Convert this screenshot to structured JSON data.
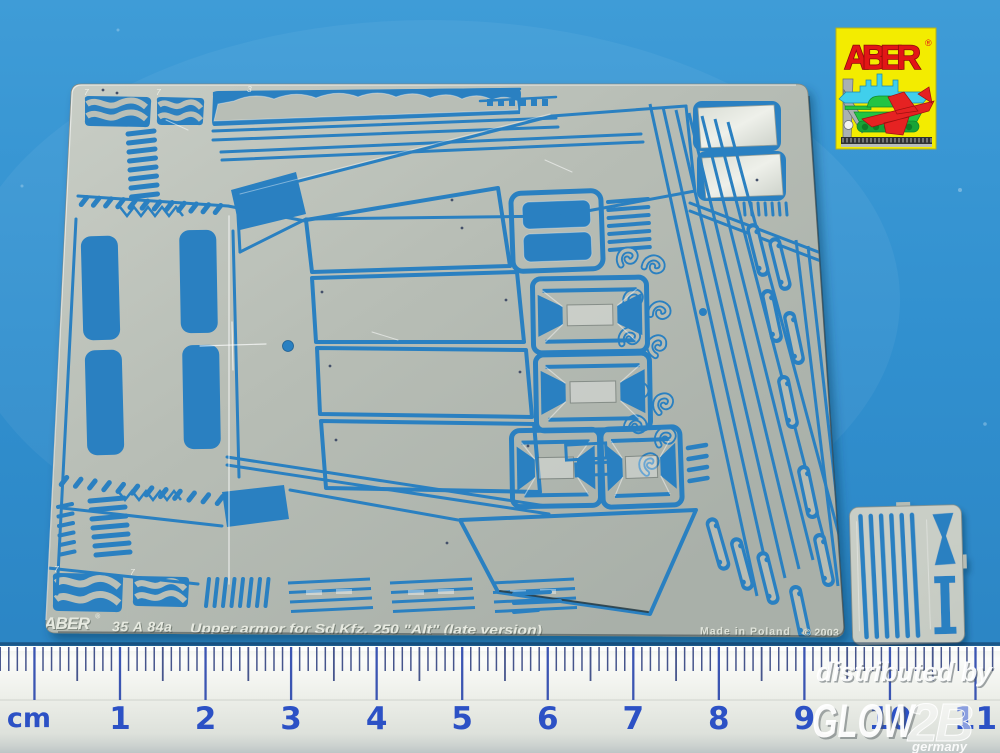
{
  "background_color": "#3190cf",
  "sheet": {
    "brand": "ABER",
    "registered_mark": "®",
    "code": "35 A 84a",
    "title": "Upper armor for Sd.Kfz. 250 \"Alt\" (late version)",
    "origin": "Made in Poland",
    "copyright": "© 2003",
    "metal_color": "#b7bdb5",
    "part_labels": [
      "7",
      "7",
      "3",
      "2",
      "7",
      "7"
    ]
  },
  "logo": {
    "brand": "ABER",
    "registered_mark": "®",
    "background_color": "#f3ec00",
    "text_color": "#e21616",
    "ship_color": "#40cfec",
    "jet_color": "#e62222",
    "tank_color": "#22c443",
    "square_color": "#aab1b1"
  },
  "ruler": {
    "unit_label": "cm",
    "numbers": [
      "1",
      "2",
      "3",
      "4",
      "5",
      "6",
      "7",
      "8",
      "9",
      "10",
      "11"
    ],
    "number_color": "#2c51c5",
    "tick_color": "#46558c",
    "cm_tick_color": "#3b55b2"
  },
  "watermark": {
    "line1": "distributed by",
    "brand": "GLOW",
    "brand_suffix": "2B",
    "country": "germany"
  }
}
